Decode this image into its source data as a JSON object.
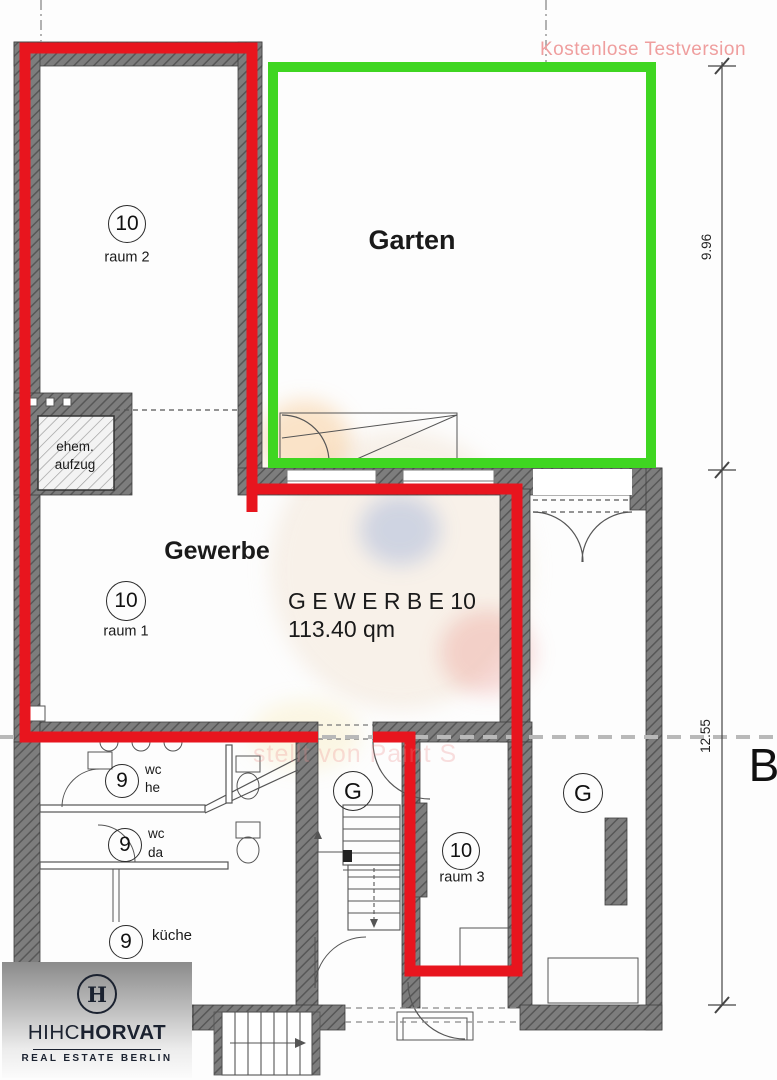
{
  "watermark_top": "Kostenlose Testversion",
  "watermark_mid": "stellt von Paint S",
  "garden": {
    "label": "Garten"
  },
  "gewerbe": {
    "label": "Gewerbe",
    "title": "G E W E R B E 10",
    "area": "113.40 qm"
  },
  "elevator": {
    "line1": "ehem.",
    "line2": "aufzug"
  },
  "rooms": {
    "raum2": {
      "num": "10",
      "label": "raum 2"
    },
    "raum1": {
      "num": "10",
      "label": "raum 1"
    },
    "raum3": {
      "num": "10",
      "label": "raum 3"
    },
    "wc_he": {
      "num": "9",
      "line1": "wc",
      "line2": "he"
    },
    "wc_da": {
      "num": "9",
      "line1": "wc",
      "line2": "da"
    },
    "kueche": {
      "num": "9",
      "label": "küche"
    },
    "g_left": {
      "num": "G"
    },
    "g_right": {
      "num": "G"
    }
  },
  "dimensions": {
    "upper": "9.96",
    "lower": "12.55",
    "section_letter": "B"
  },
  "logo": {
    "monogram": "H",
    "brand_thin": "HIHC",
    "brand_bold": "HORVAT",
    "subtitle": "REAL ESTATE BERLIN"
  },
  "colors": {
    "outline_red": "#e8151e",
    "outline_green": "#3fd621",
    "watermark_pink": "#ef9e9e",
    "watermark_faint": "rgba(236,136,136,0.30)"
  }
}
